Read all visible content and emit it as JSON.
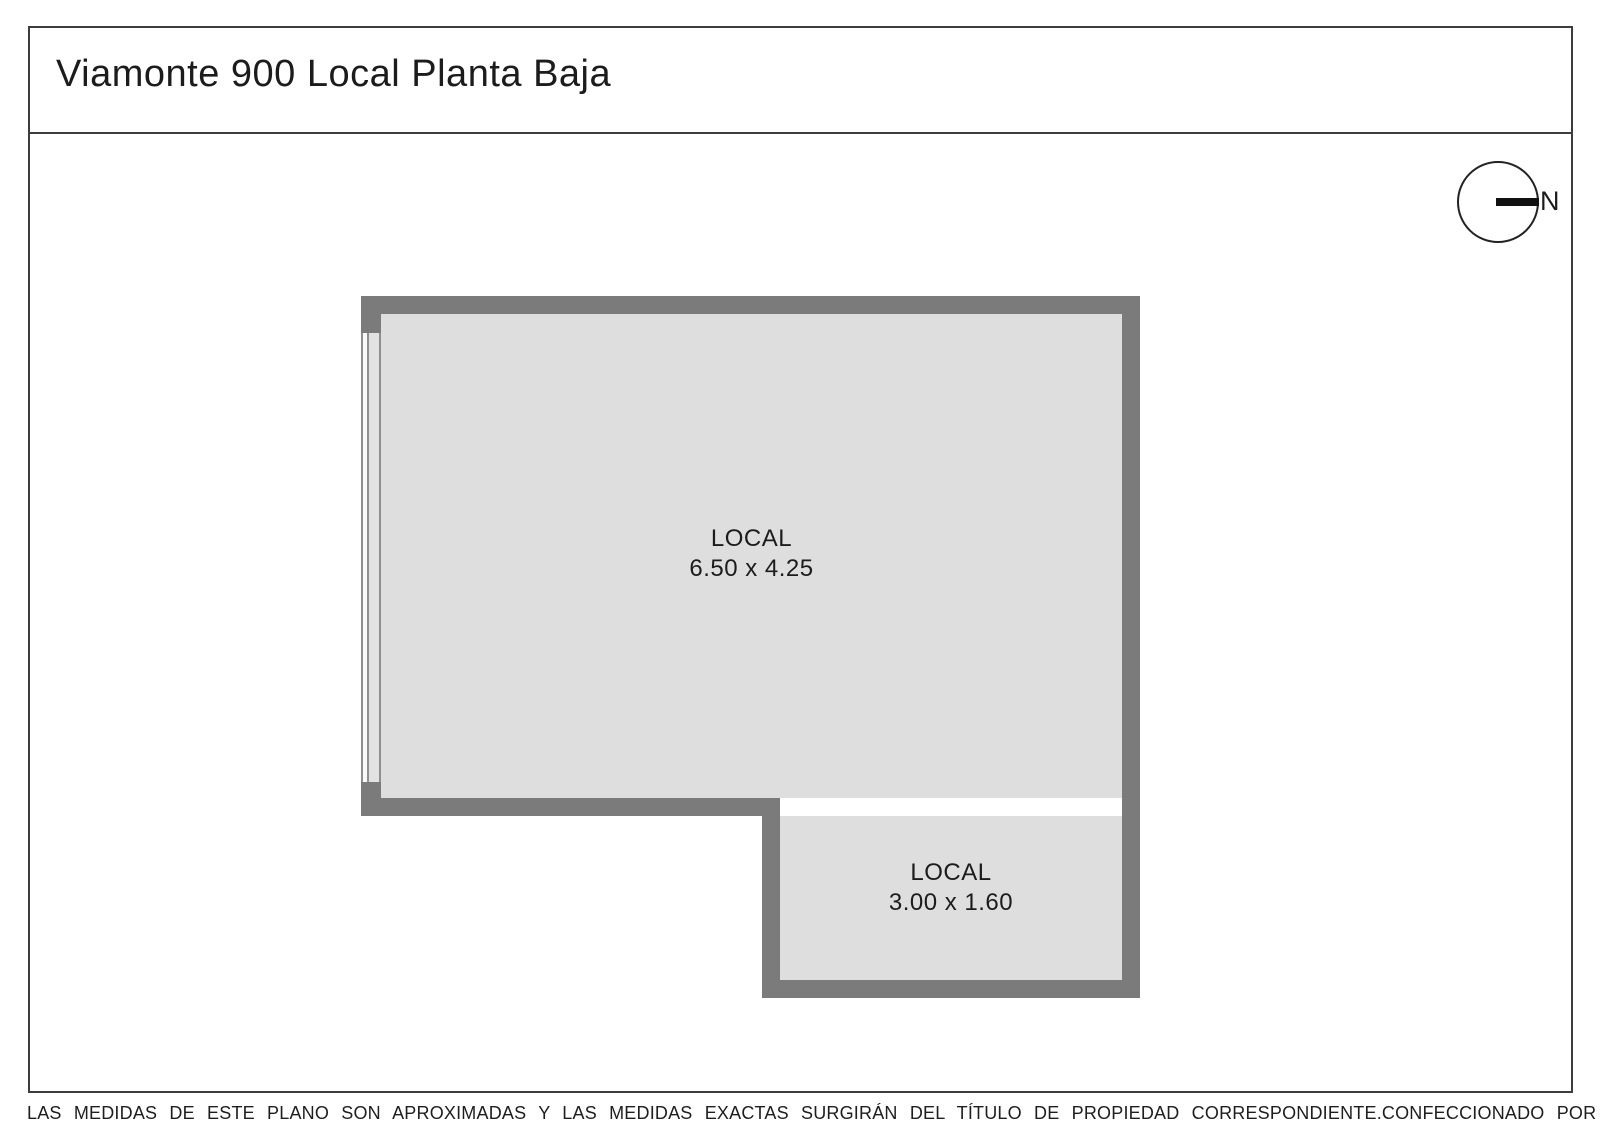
{
  "title": "Viamonte 900 Local Planta Baja",
  "compass": {
    "north_label": "N"
  },
  "rooms": [
    {
      "name": "LOCAL",
      "dimensions": "6.50 x 4.25"
    },
    {
      "name": "LOCAL",
      "dimensions": "3.00 x 1.60"
    }
  ],
  "footer": {
    "disclaimer": "LAS MEDIDAS  DE ESTE PLANO SON APROXIMADAS Y LAS MEDIDAS EXACTAS SURGIRÁN DEL TÍTULO DE PROPIEDAD CORRESPONDIENTE.",
    "credit": "CONFECCIONADO POR ESTUDIO NARTEX"
  },
  "colors": {
    "wall": "#7b7b7b",
    "floor": "#dedede",
    "line": "#3d3d3d",
    "ink": "#1c1c1c"
  }
}
